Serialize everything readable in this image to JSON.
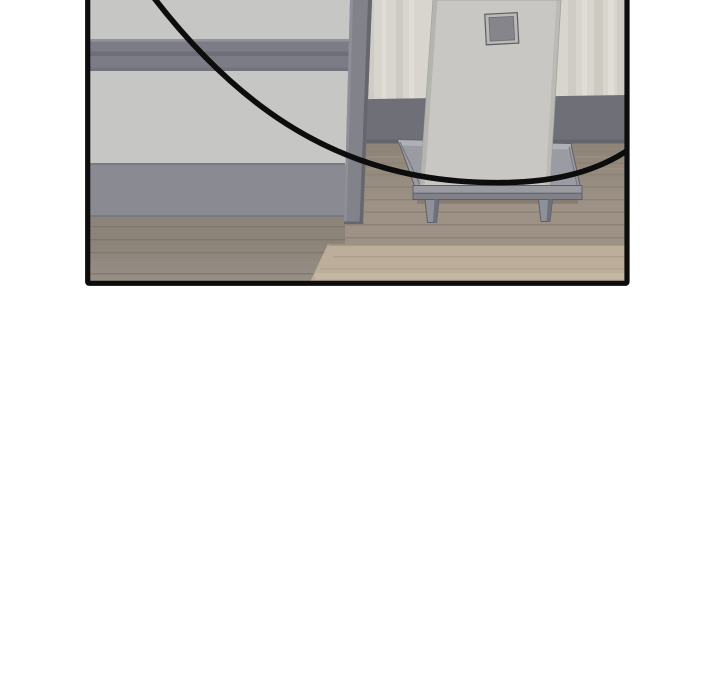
{
  "panel": {
    "type": "webtoon-comic-panel",
    "description": "Bottom portion of a comic panel, cut off at the top: room interior with a gray partition wall and horizontal rail on the left, a vertical frame post, a tall light-gray slab with a small dark square standing on a low gray plinth with legs, wood plank flooring, and the sweeping lower edge of a large round speech balloon crossing the panel.",
    "border_color": "#0d0d0d",
    "outside_background": "#ffffff"
  },
  "colors": {
    "wall_left": "#c6c6c4",
    "rail": "#7c7c86",
    "baseboard_left": "#8a8a92",
    "floor_left": "#8c8379",
    "wall_right": "#d7d5cd",
    "baseboard_right": "#6f6f77",
    "floor_right": "#9d9285",
    "floor_light_band": "#bcae9b",
    "post": "#82828a",
    "slab": "#c8c7c3",
    "slab_square_frame": "#b9b9b5",
    "slab_square": "#85858b",
    "stand": "#9b9ca3",
    "stand_base_top": "#9a9ba1",
    "stand_base_front": "#80818a",
    "stand_leg": "#8f919a",
    "balloon_line": "#0d0d0d"
  }
}
